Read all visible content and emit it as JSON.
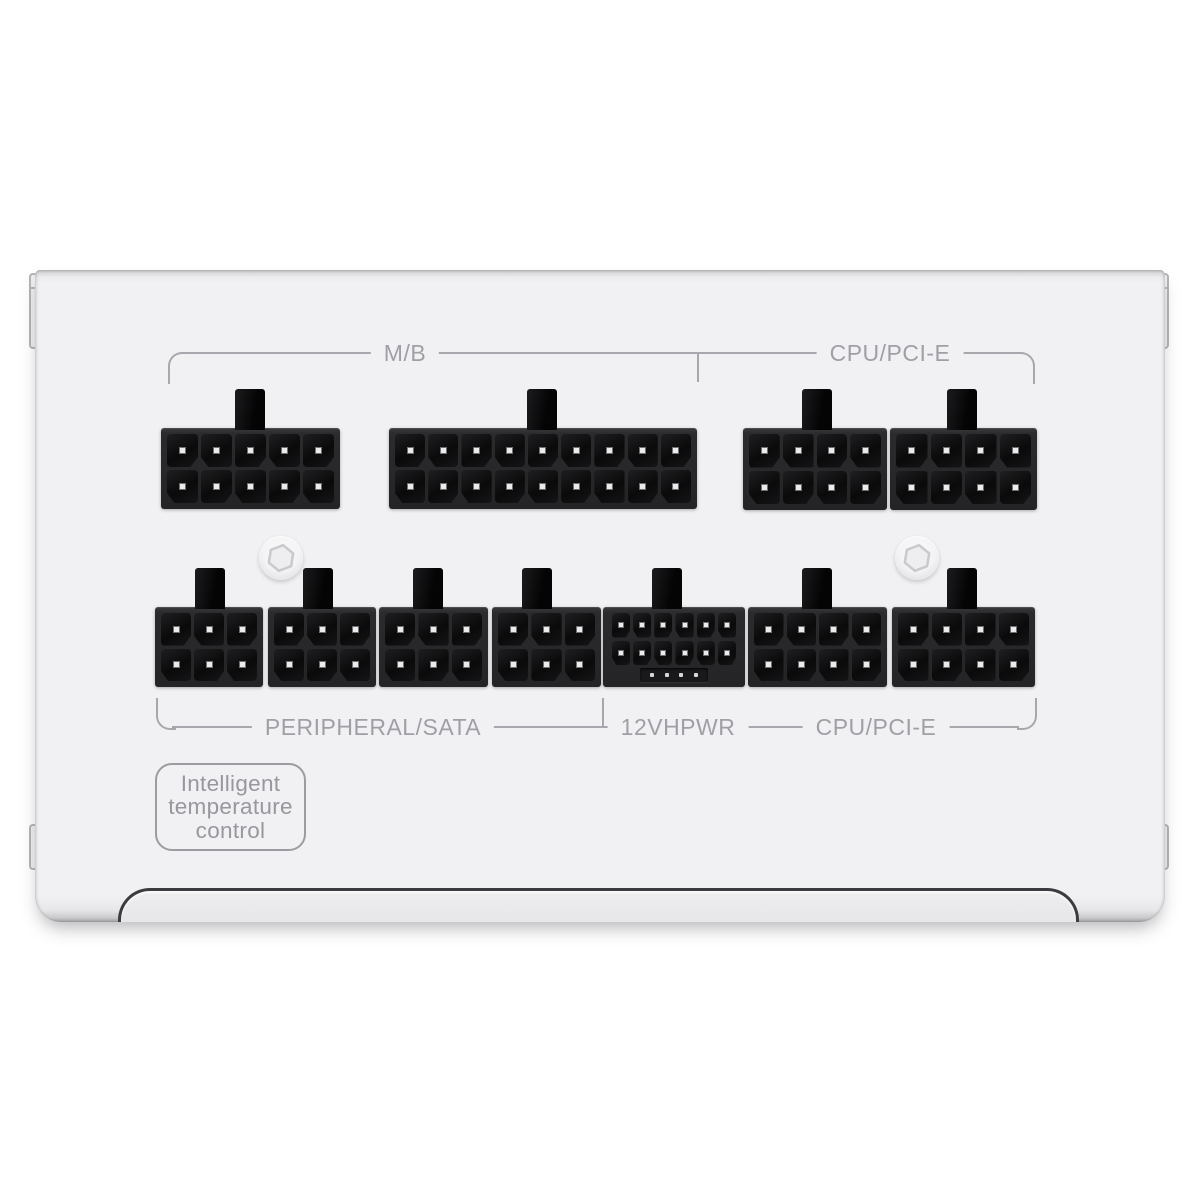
{
  "labels": {
    "mb": "M/B",
    "cpu_pcie_top": "CPU/PCI-E",
    "peripheral_sata": "PERIPHERAL/SATA",
    "hpwr": "12VHPWR",
    "cpu_pcie_bottom": "CPU/PCI-E"
  },
  "badge": {
    "lines": [
      "Intelligent",
      "temperature",
      "control"
    ]
  },
  "colors": {
    "background": "#ffffff",
    "panel": "#f1f1f3",
    "connector_black": "#141416",
    "bracket_line": "#a7a8ad",
    "annotation_text": "#9fa0a6",
    "pin_contact": "#ebebeb"
  },
  "connectors": {
    "top_row": [
      {
        "name": "mb-10pin",
        "group": "M/B",
        "pins": 10,
        "rows": 2,
        "cols": 5,
        "x": 161,
        "y": 428,
        "w": 179,
        "h": 81,
        "tab_cx": 250
      },
      {
        "name": "mb-18pin",
        "group": "M/B",
        "pins": 18,
        "rows": 2,
        "cols": 9,
        "x": 389,
        "y": 428,
        "w": 308,
        "h": 81,
        "tab_cx": 542
      },
      {
        "name": "cpu-pcie-8pin-1",
        "group": "CPU/PCI-E",
        "pins": 8,
        "rows": 2,
        "cols": 4,
        "x": 743,
        "y": 428,
        "w": 144,
        "h": 82,
        "tab_cx": 817
      },
      {
        "name": "cpu-pcie-8pin-2",
        "group": "CPU/PCI-E",
        "pins": 8,
        "rows": 2,
        "cols": 4,
        "x": 890,
        "y": 428,
        "w": 147,
        "h": 82,
        "tab_cx": 962
      }
    ],
    "bottom_row": [
      {
        "name": "peripheral-sata-6pin-1",
        "group": "PERIPHERAL/SATA",
        "pins": 6,
        "rows": 2,
        "cols": 3,
        "x": 155,
        "y": 607,
        "w": 108,
        "h": 80,
        "tab_cx": 210
      },
      {
        "name": "peripheral-sata-6pin-2",
        "group": "PERIPHERAL/SATA",
        "pins": 6,
        "rows": 2,
        "cols": 3,
        "x": 268,
        "y": 607,
        "w": 108,
        "h": 80,
        "tab_cx": 318
      },
      {
        "name": "peripheral-sata-6pin-3",
        "group": "PERIPHERAL/SATA",
        "pins": 6,
        "rows": 2,
        "cols": 3,
        "x": 379,
        "y": 607,
        "w": 109,
        "h": 80,
        "tab_cx": 428
      },
      {
        "name": "peripheral-sata-6pin-4",
        "group": "PERIPHERAL/SATA",
        "pins": 6,
        "rows": 2,
        "cols": 3,
        "x": 492,
        "y": 607,
        "w": 109,
        "h": 80,
        "tab_cx": 537
      },
      {
        "name": "12vhpwr-12plus4",
        "group": "12VHPWR",
        "pins": 12,
        "rows": 2,
        "cols": 6,
        "x": 603,
        "y": 607,
        "w": 142,
        "h": 80,
        "tab_cx": 667,
        "type": "hpwr",
        "sense_pins": 4
      },
      {
        "name": "cpu-pcie-8pin-3",
        "group": "CPU/PCI-E",
        "pins": 8,
        "rows": 2,
        "cols": 4,
        "x": 748,
        "y": 607,
        "w": 139,
        "h": 80,
        "tab_cx": 817
      },
      {
        "name": "cpu-pcie-8pin-4",
        "group": "CPU/PCI-E",
        "pins": 8,
        "rows": 2,
        "cols": 4,
        "x": 892,
        "y": 607,
        "w": 143,
        "h": 80,
        "tab_cx": 962
      }
    ]
  },
  "screws": [
    {
      "name": "hex-screw-left",
      "cx": 281,
      "cy": 558
    },
    {
      "name": "hex-screw-right",
      "cx": 917,
      "cy": 558
    }
  ]
}
